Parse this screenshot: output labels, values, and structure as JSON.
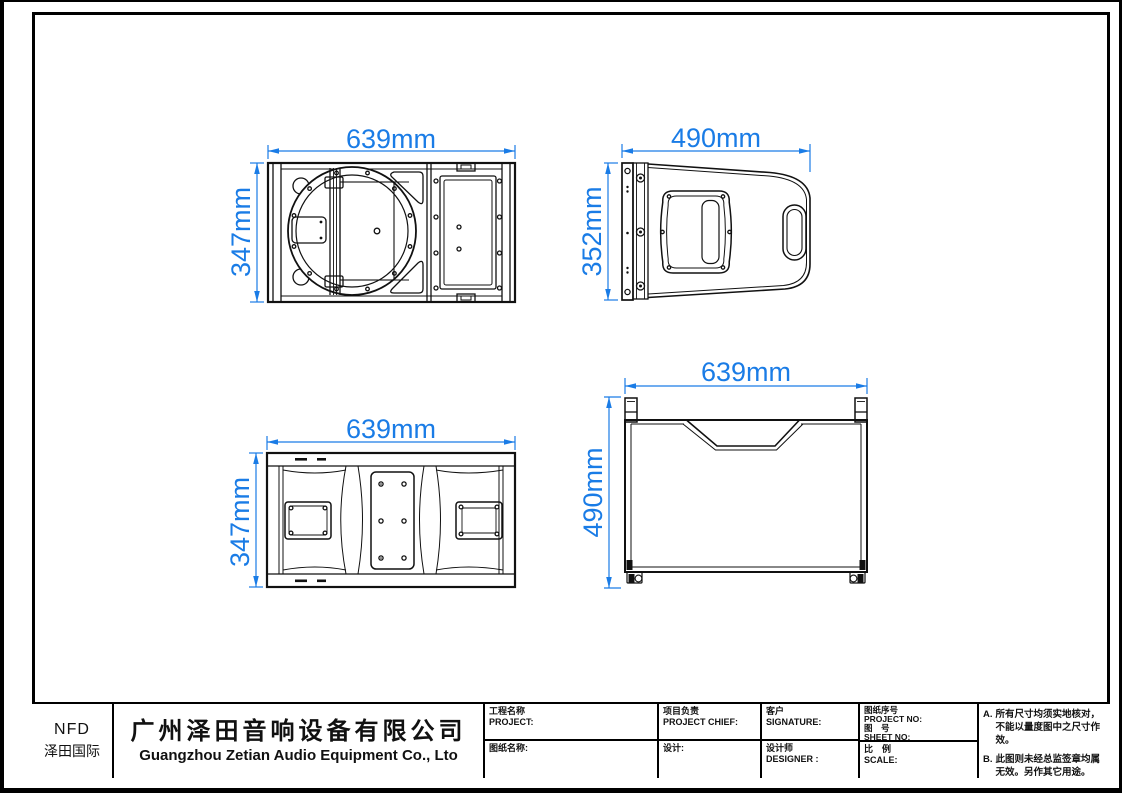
{
  "colors": {
    "dimension_blue": "#1a7ce6",
    "line_black": "#111111"
  },
  "views": {
    "front": {
      "width_label": "639mm",
      "height_label": "347mm"
    },
    "side": {
      "width_label": "490mm",
      "height_label": "352mm"
    },
    "rear": {
      "width_label": "639mm",
      "height_label": "347mm"
    },
    "top": {
      "width_label": "639mm",
      "height_label": "490mm"
    }
  },
  "title_block": {
    "logo": {
      "line1": "NFD",
      "line2": "泽田国际"
    },
    "company": {
      "cn": "广州泽田音响设备有限公司",
      "en": "Guangzhou Zetian Audio Equipment Co., Lto"
    },
    "fields": {
      "project": "工程名称\nPROJECT:",
      "drawing_name": "图纸名称:",
      "project_chief": "项目负责\nPROJECT CHIEF:",
      "design": "设计:",
      "customer": "客户\nSIGNATURE:",
      "designer": "设计师\nDESIGNER :",
      "project_no": "图纸序号\nPROJECT NO:\n图　号\nSHEET NO:",
      "scale": "比　例\nSCALE:"
    },
    "notes": [
      {
        "label": "A.",
        "text": "所有尺寸均须实地核对，不能以量度图中之尺寸作效。"
      },
      {
        "label": "B.",
        "text": "此图则未经总监签章均属无效。另作其它用途。"
      }
    ]
  }
}
